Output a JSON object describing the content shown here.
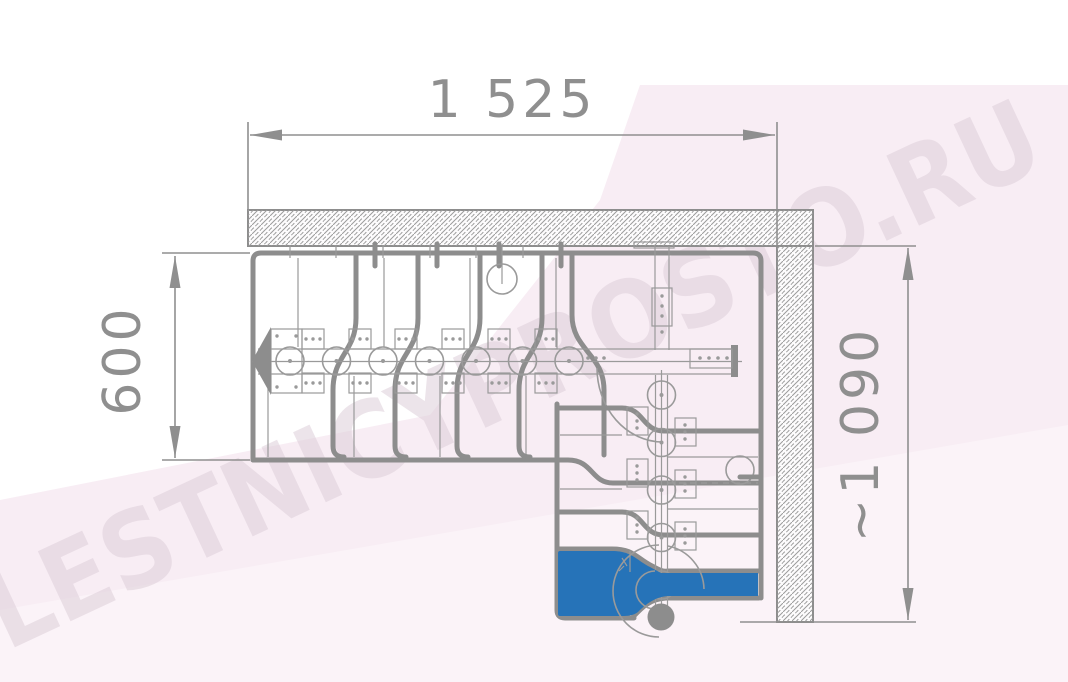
{
  "title": "L-shaped modular goose-step staircase plan (top view)",
  "watermark": {
    "text": "LESTNICYPROSTO.RU"
  },
  "dimensions": {
    "top_width": "1 525",
    "left_flight_width": "600",
    "right_height": "~1 090"
  },
  "colors": {
    "line_gray": "#8d8d8d",
    "thin_gray": "#9a9a9a",
    "dim_gray": "#8f8f8f",
    "hatch_gray": "#9b9b9b",
    "wall_fill": "#fdfcfd",
    "accent_blue": "#2673b8",
    "bg_pink": "#f8edf4",
    "bg_pink_light": "#fbf3f8",
    "watermark": "#ddcfd9"
  }
}
